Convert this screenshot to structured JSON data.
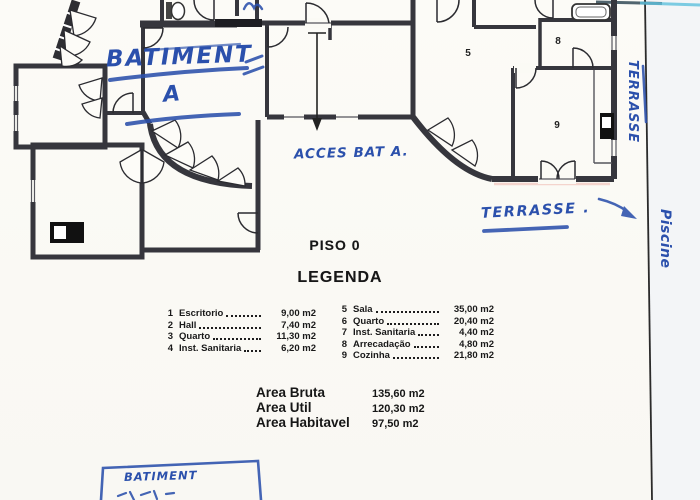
{
  "document": {
    "floor_label": "PISO 0",
    "legend_title": "LEGENDA",
    "legend_left": [
      {
        "num": "1",
        "label": "Escritorio",
        "value": "9,00 m2"
      },
      {
        "num": "2",
        "label": "Hall",
        "value": "7,40 m2"
      },
      {
        "num": "3",
        "label": "Quarto",
        "value": "11,30 m2"
      },
      {
        "num": "4",
        "label": "Inst. Sanitaria",
        "value": "6,20 m2"
      }
    ],
    "legend_right": [
      {
        "num": "5",
        "label": "Sala",
        "value": "35,00 m2"
      },
      {
        "num": "6",
        "label": "Quarto",
        "value": "20,40 m2"
      },
      {
        "num": "7",
        "label": "Inst. Sanitaria",
        "value": "4,40 m2"
      },
      {
        "num": "8",
        "label": "Arrecadação",
        "value": "4,80 m2"
      },
      {
        "num": "9",
        "label": "Cozinha",
        "value": "21,80 m2"
      }
    ],
    "areas": [
      {
        "label": "Area Bruta",
        "value": "135,60 m2"
      },
      {
        "label": "Area Util",
        "value": "120,30 m2"
      },
      {
        "label": "Area Habitavel",
        "value": "97,50 m2"
      }
    ]
  },
  "annotations": {
    "building_label": "BATIMENT",
    "building_letter": "A",
    "access_note": "ACCES BAT A.",
    "terrace_note": "TERRASSE .",
    "terrace_side_note": "TERRASSE",
    "pool_side_note": "Piscine",
    "stamp_box_label": "BATIMENT"
  },
  "plan": {
    "rooms": {
      "sala": "5",
      "arrecadacao": "8",
      "cozinha": "9"
    }
  },
  "colors": {
    "ink_blue": "#2b50ac",
    "wall_dark": "#36363d",
    "cyan_streak": "#5ec1de"
  }
}
